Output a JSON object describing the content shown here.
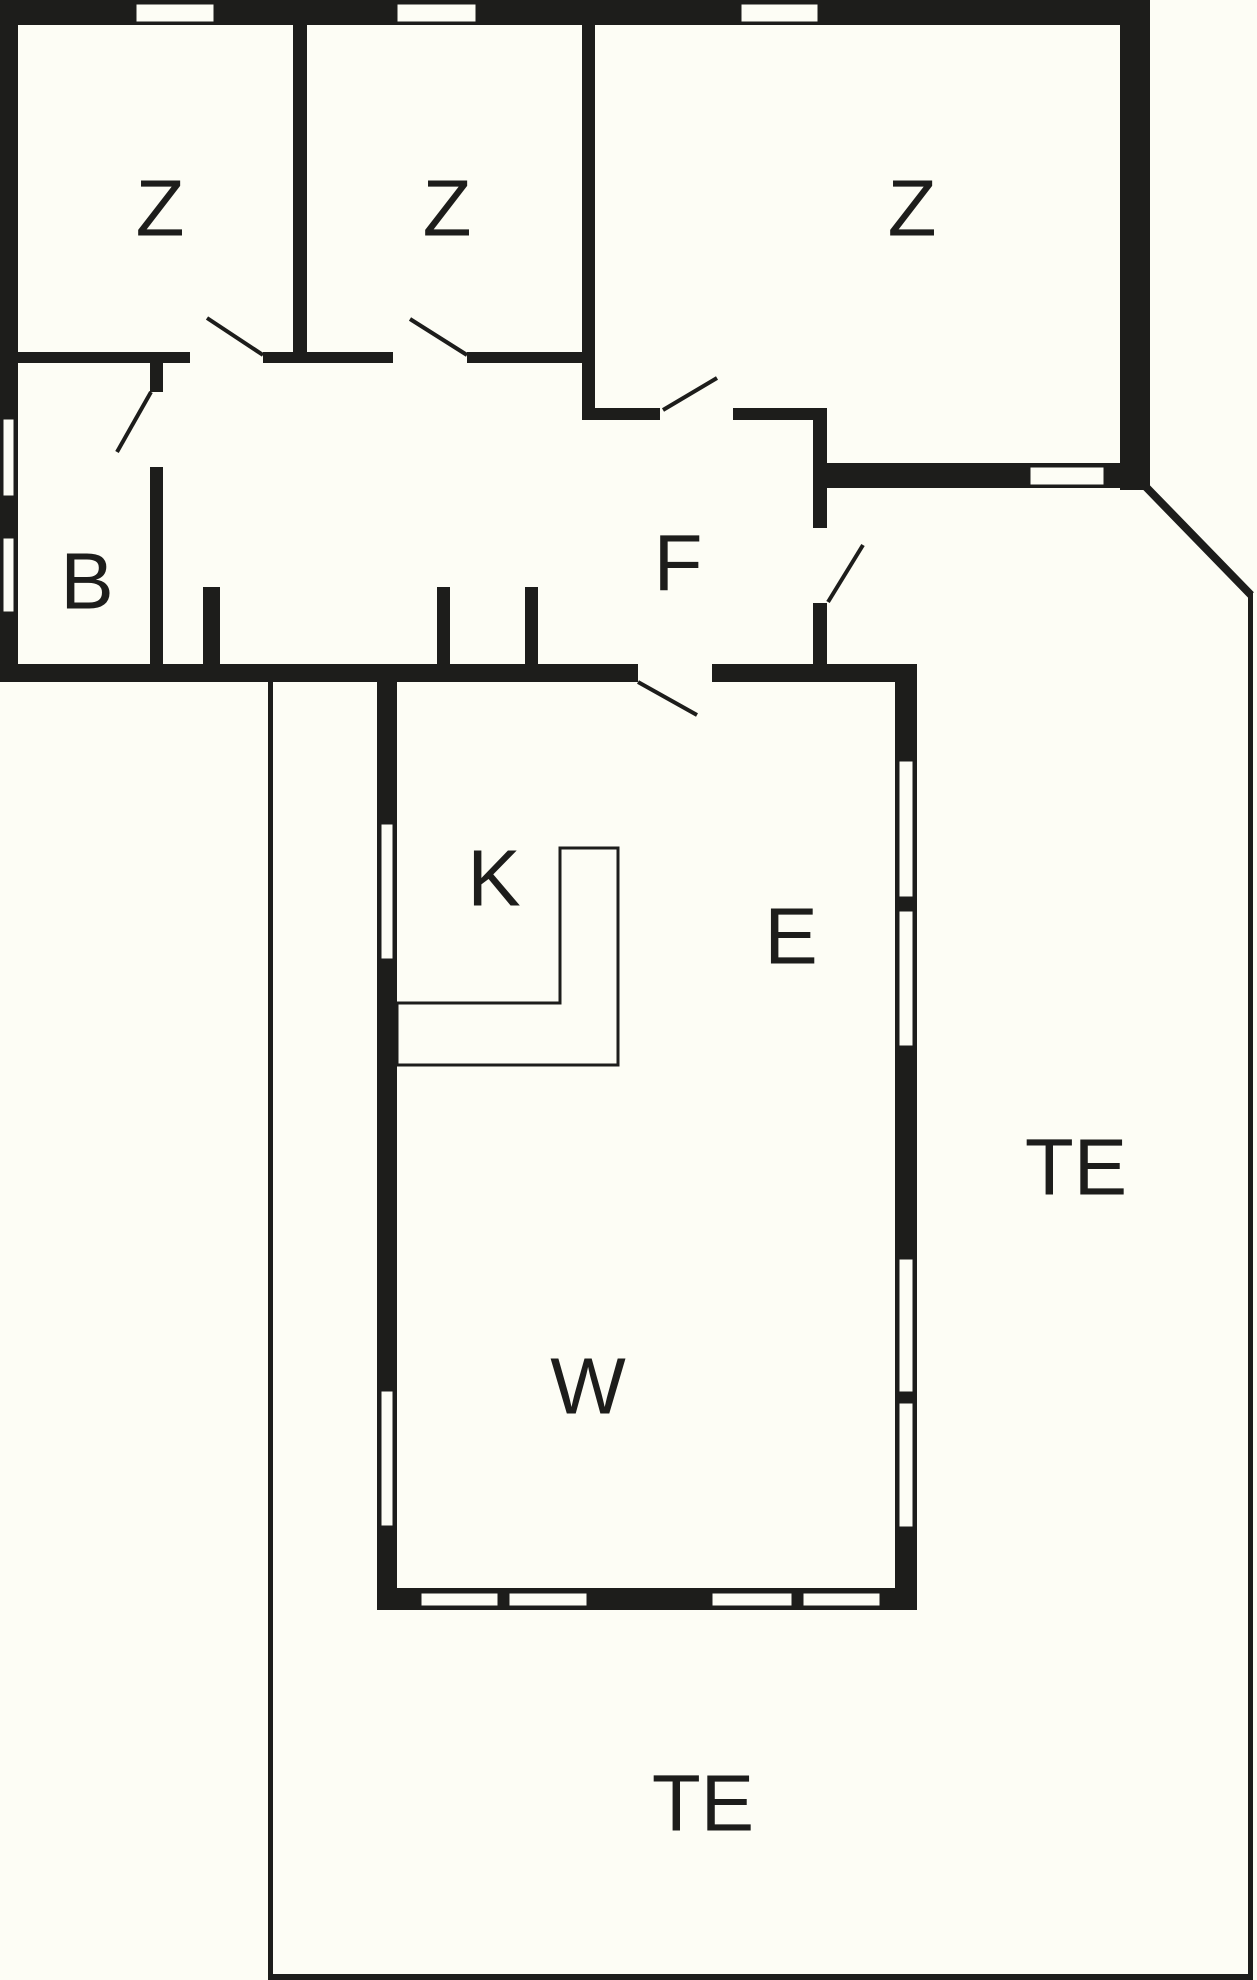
{
  "title": "Holiday house floor plan",
  "colors": {
    "background": "#FDFDF5",
    "wall": "#1D1D1B"
  },
  "rooms": [
    {
      "id": "bedroom-1",
      "label": "Z",
      "x": 160,
      "y": 208
    },
    {
      "id": "bedroom-2",
      "label": "Z",
      "x": 447,
      "y": 208
    },
    {
      "id": "bedroom-3",
      "label": "Z",
      "x": 912,
      "y": 208
    },
    {
      "id": "bathroom",
      "label": "B",
      "x": 87,
      "y": 581
    },
    {
      "id": "hallway",
      "label": "F",
      "x": 678,
      "y": 563
    },
    {
      "id": "kitchen",
      "label": "K",
      "x": 494,
      "y": 878
    },
    {
      "id": "dining-area",
      "label": "E",
      "x": 791,
      "y": 936
    },
    {
      "id": "living-room",
      "label": "W",
      "x": 588,
      "y": 1386
    },
    {
      "id": "terrace-east",
      "label": "TE",
      "x": 1076,
      "y": 1167
    },
    {
      "id": "terrace-south",
      "label": "TE",
      "x": 703,
      "y": 1803
    }
  ],
  "floorplan": {
    "label_font_size": 80,
    "walls": [
      [
        0,
        0,
        1150,
        25
      ],
      [
        0,
        0,
        18,
        682
      ],
      [
        293,
        25,
        14,
        327
      ],
      [
        582,
        25,
        13,
        395
      ],
      [
        18,
        352,
        172,
        11
      ],
      [
        263,
        352,
        130,
        11
      ],
      [
        467,
        352,
        116,
        11
      ],
      [
        1120,
        0,
        30,
        490
      ],
      [
        827,
        463,
        323,
        25
      ],
      [
        582,
        408,
        78,
        12
      ],
      [
        733,
        408,
        94,
        12
      ],
      [
        813,
        420,
        14,
        108
      ],
      [
        813,
        603,
        14,
        79
      ],
      [
        150,
        363,
        13,
        29
      ],
      [
        150,
        467,
        13,
        215
      ],
      [
        0,
        664,
        638,
        18
      ],
      [
        712,
        664,
        205,
        18
      ],
      [
        203,
        587,
        17,
        78
      ],
      [
        437,
        587,
        13,
        95
      ],
      [
        525,
        587,
        13,
        78
      ],
      [
        377,
        682,
        20,
        928
      ],
      [
        895,
        682,
        22,
        928
      ],
      [
        377,
        1588,
        540,
        22
      ]
    ],
    "windows": [
      [
        135,
        3,
        80,
        20
      ],
      [
        396,
        3,
        81,
        20
      ],
      [
        740,
        3,
        79,
        20
      ],
      [
        1029,
        466,
        76,
        20
      ],
      [
        2,
        418,
        13,
        79
      ],
      [
        2,
        537,
        13,
        76
      ],
      [
        380,
        823,
        14,
        137
      ],
      [
        380,
        1390,
        14,
        137
      ],
      [
        898,
        760,
        16,
        138
      ],
      [
        898,
        910,
        16,
        137
      ],
      [
        898,
        1258,
        16,
        135
      ],
      [
        898,
        1402,
        16,
        126
      ],
      [
        420,
        1592,
        79,
        15
      ],
      [
        508,
        1592,
        80,
        15
      ],
      [
        711,
        1592,
        82,
        15
      ],
      [
        802,
        1592,
        79,
        15
      ]
    ],
    "terrace_edges": [
      [
        268,
        682,
        5,
        1298
      ],
      [
        268,
        1974,
        985,
        6
      ],
      [
        1248,
        592,
        5,
        1388
      ]
    ],
    "diagonal_edge": [
      1146,
      487,
      1251,
      595
    ],
    "door_swings": [
      [
        263,
        355,
        207,
        318
      ],
      [
        467,
        355,
        410,
        319
      ],
      [
        151,
        392,
        117,
        452
      ],
      [
        663,
        410,
        717,
        378
      ],
      [
        828,
        602,
        863,
        545
      ],
      [
        638,
        682,
        697,
        715
      ]
    ],
    "counter_points": "560,848 618,848 618,1065 397,1065 397,1003 560,1003",
    "stroke_widths": {
      "window_outline": 3,
      "door_swing": 4,
      "diagonal": 8,
      "counter": 3
    }
  }
}
